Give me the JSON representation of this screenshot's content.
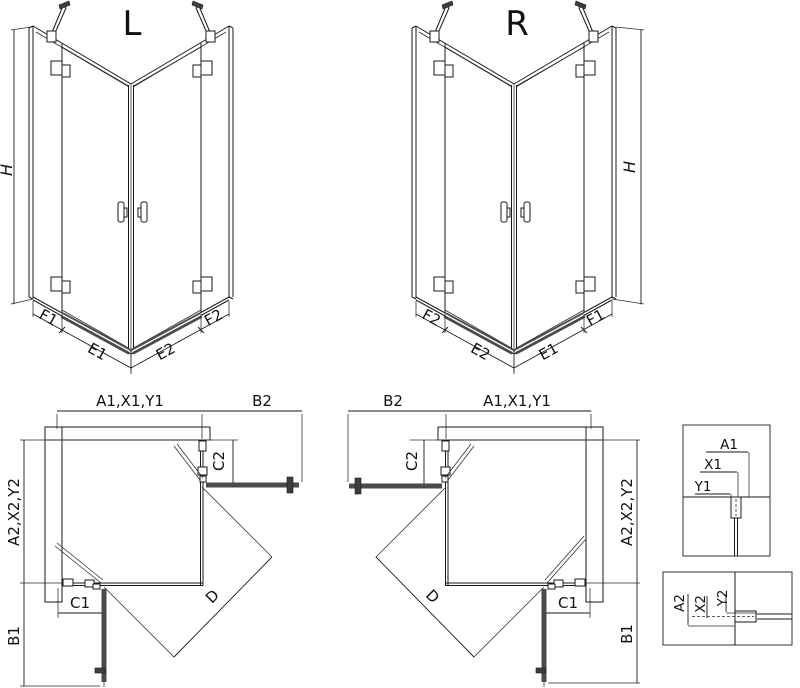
{
  "drawing_title": "Corner shower enclosure dimension drawing, left (L) and right (R) versions",
  "colors": {
    "line": "#1a1a1a",
    "door_panel": "#4a4a4a",
    "background": "#ffffff"
  },
  "views": {
    "l3d": {
      "title": "L",
      "dim_h": "H",
      "dim_f1": "F1",
      "dim_e1": "E1",
      "dim_e2": "E2",
      "dim_f2": "F2"
    },
    "r3d": {
      "title": "R",
      "dim_h": "H",
      "dim_f1": "F1",
      "dim_e1": "E1",
      "dim_e2": "E2",
      "dim_f2": "F2"
    },
    "lplan": {
      "dim_top": "A1,X1,Y1",
      "dim_b2": "B2",
      "dim_c2": "C2",
      "dim_side": "A2,X2,Y2",
      "dim_c1": "C1",
      "dim_b1": "B1",
      "dim_d": "D"
    },
    "rplan": {
      "dim_top": "A1,X1,Y1",
      "dim_b2": "B2",
      "dim_c2": "C2",
      "dim_side": "A2,X2,Y2",
      "dim_c1": "C1",
      "dim_b1": "B1",
      "dim_d": "D"
    },
    "detail_top": {
      "dim_a1": "A1",
      "dim_x1": "X1",
      "dim_y1": "Y1"
    },
    "detail_bottom": {
      "dim_a2": "A2",
      "dim_x2": "X2",
      "dim_y2": "Y2"
    }
  }
}
